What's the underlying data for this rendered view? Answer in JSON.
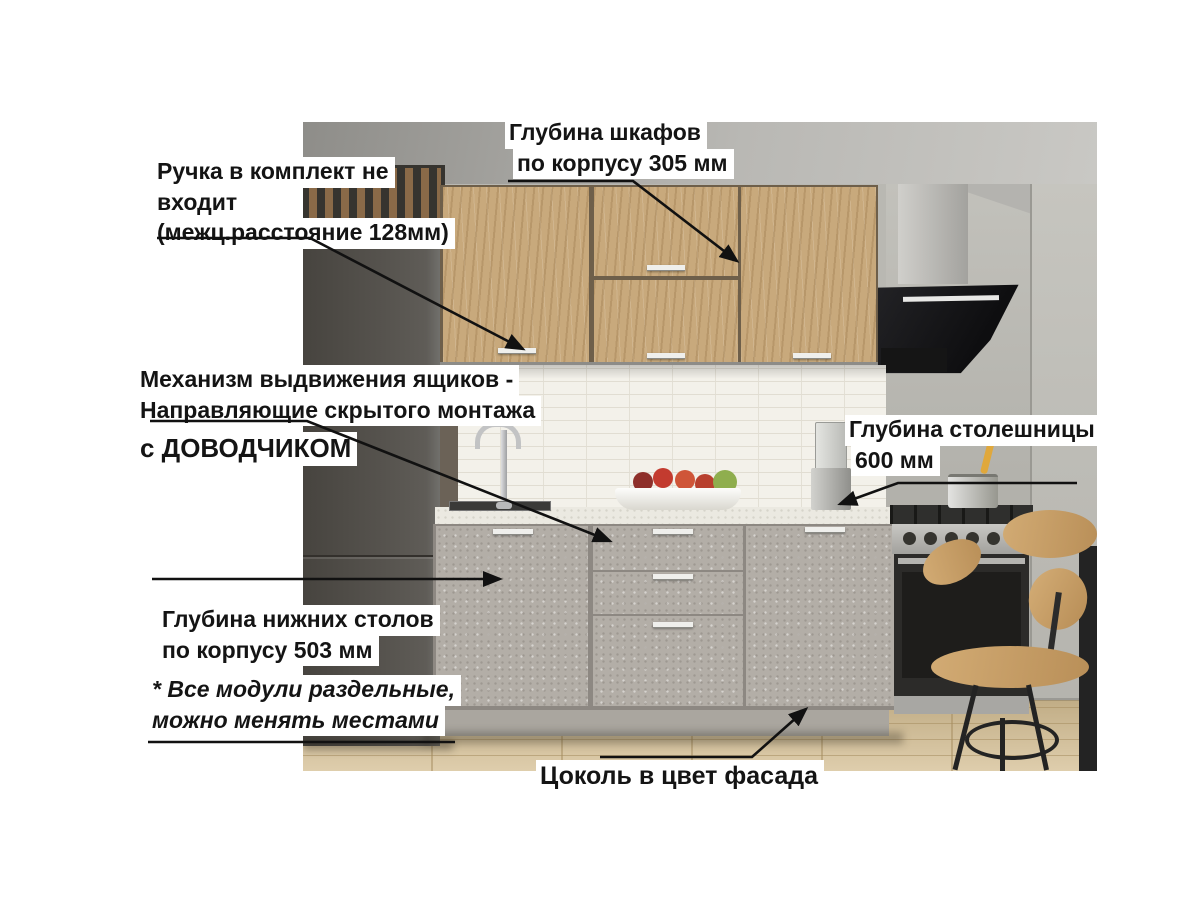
{
  "annotations": {
    "cabinet_depth": {
      "line1": "Глубина шкафов",
      "line2": " по корпусу 305 мм"
    },
    "handle_note": {
      "line1": "Ручка в комплект не",
      "line2": "входит",
      "line3": "(межц.расстояние 128мм)"
    },
    "drawer_mechanism": {
      "line1": "Механизм выдвижения ящиков -",
      "line2": "Направляющие скрытого монтажа",
      "line3": "с ДОВОДЧИКОМ"
    },
    "countertop_depth": {
      "line1": "Глубина столешницы",
      "line2": " 600 мм"
    },
    "base_units_depth": {
      "line1": "Глубина нижних столов",
      "line2": "по корпусу 503 мм"
    },
    "modules_note": {
      "line1": "* Все модули раздельные,",
      "line2": "можно менять местами"
    },
    "plinth_note": {
      "line1": "Цоколь в цвет фасада"
    }
  },
  "colors": {
    "label_text": "#141414",
    "label_background": "#ffffff",
    "arrow": "#111111",
    "cabinet_wood": "#c8a97c",
    "concrete_facade": "#b3aea7",
    "fridge": "#55524d",
    "countertop": "#ebe9e1",
    "backsplash": "#f3f1ea",
    "floor": "#d9c59e",
    "hood": "#141416"
  }
}
